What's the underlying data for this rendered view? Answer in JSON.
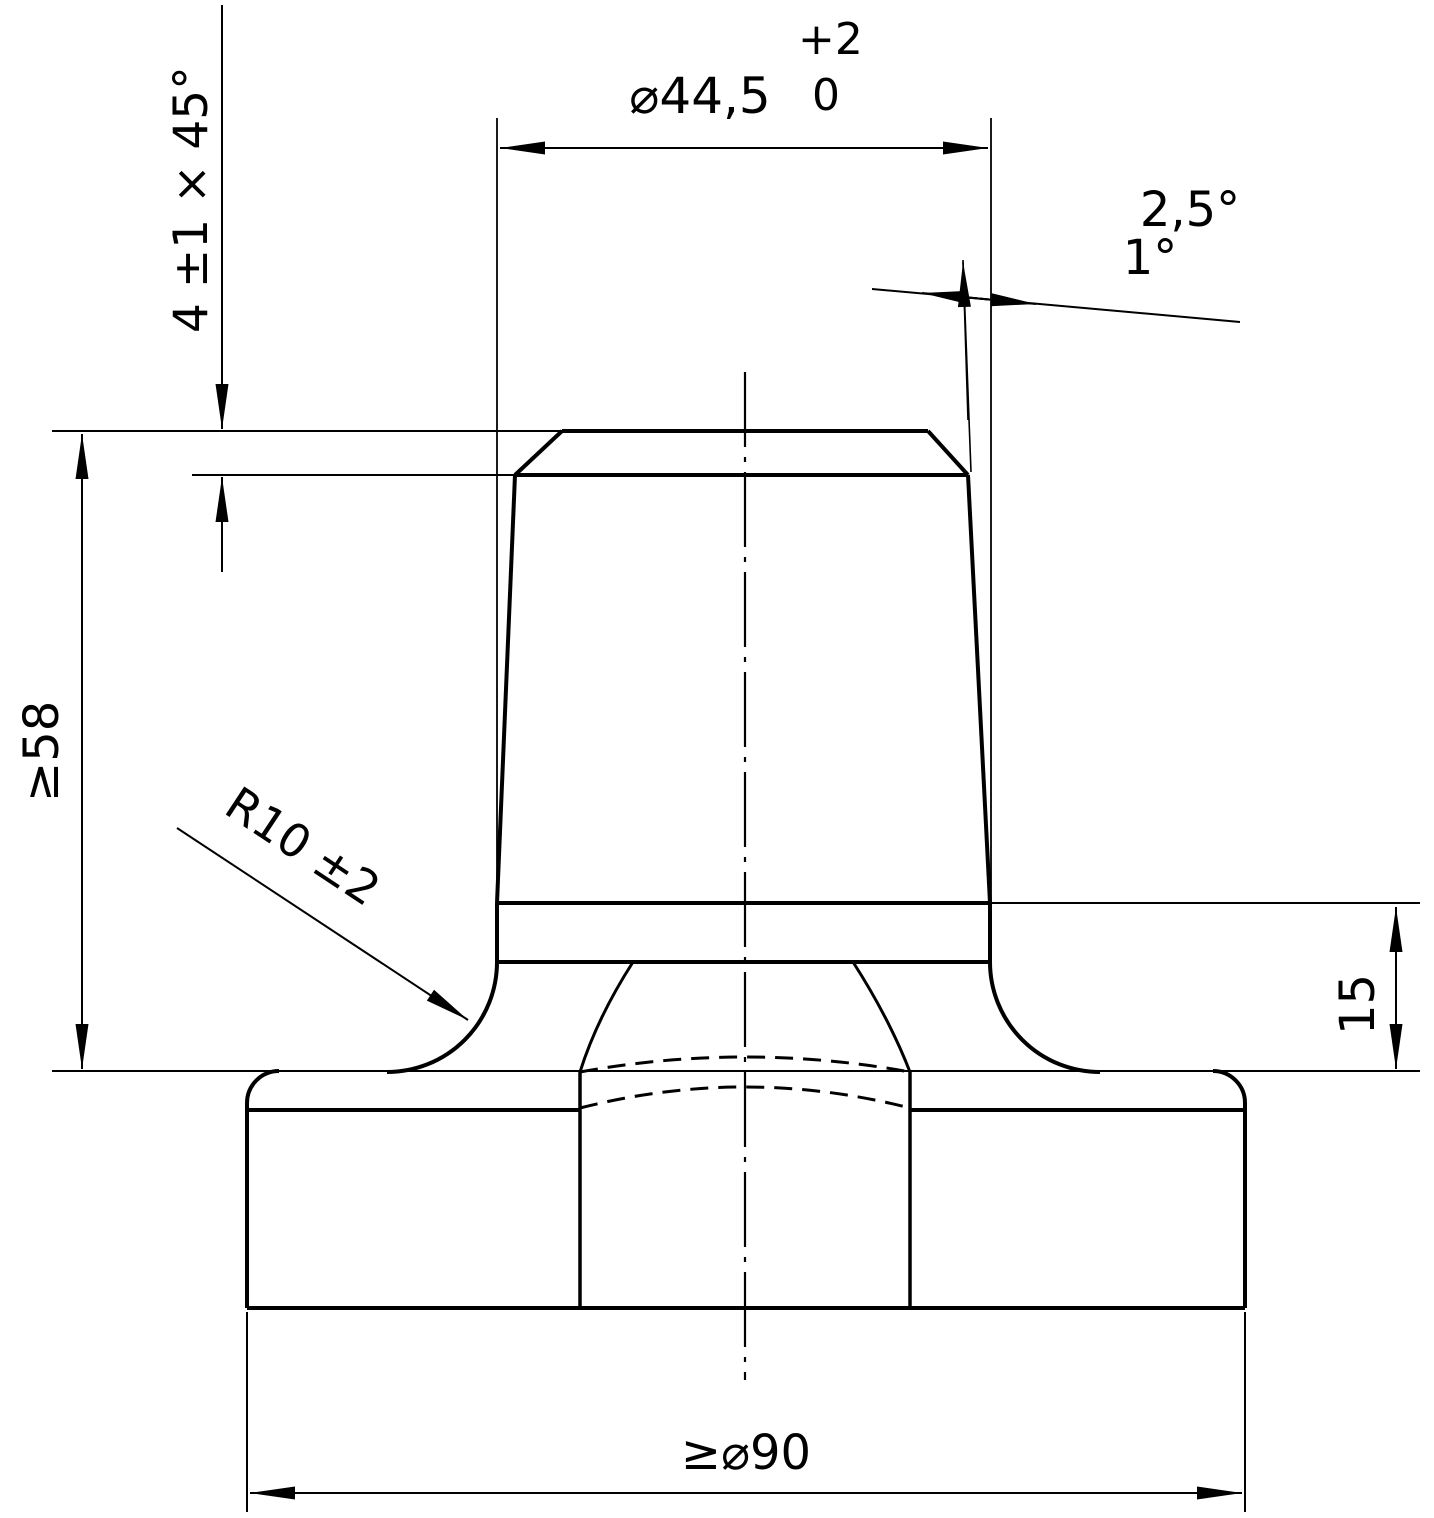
{
  "drawing": {
    "labels": {
      "dia_top": "⌀44,5",
      "dia_top_tol_plus": "+2",
      "dia_top_tol_zero": "0",
      "chamfer": "4 ±1 × 45°",
      "angle_max": "2,5°",
      "angle_min": "1°",
      "height_min": "≥58",
      "fillet_radius": "R10 ±2",
      "collar_height": "15",
      "dia_base": "≥⌀90"
    },
    "colors": {
      "line": "#000000",
      "background": "#ffffff"
    }
  }
}
